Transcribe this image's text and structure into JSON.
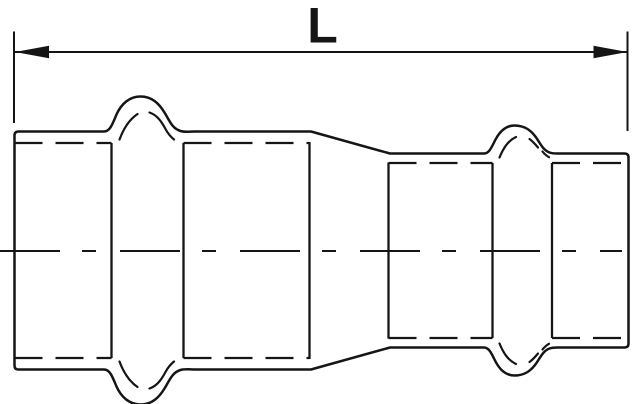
{
  "page": {
    "background": "#ffffff",
    "width": 640,
    "height": 404
  },
  "drawing": {
    "type": "technical-drawing",
    "subject": "press-fit reducing coupling, side elevation",
    "stroke_color": "#151515",
    "dimension": {
      "label": "L"
    }
  }
}
